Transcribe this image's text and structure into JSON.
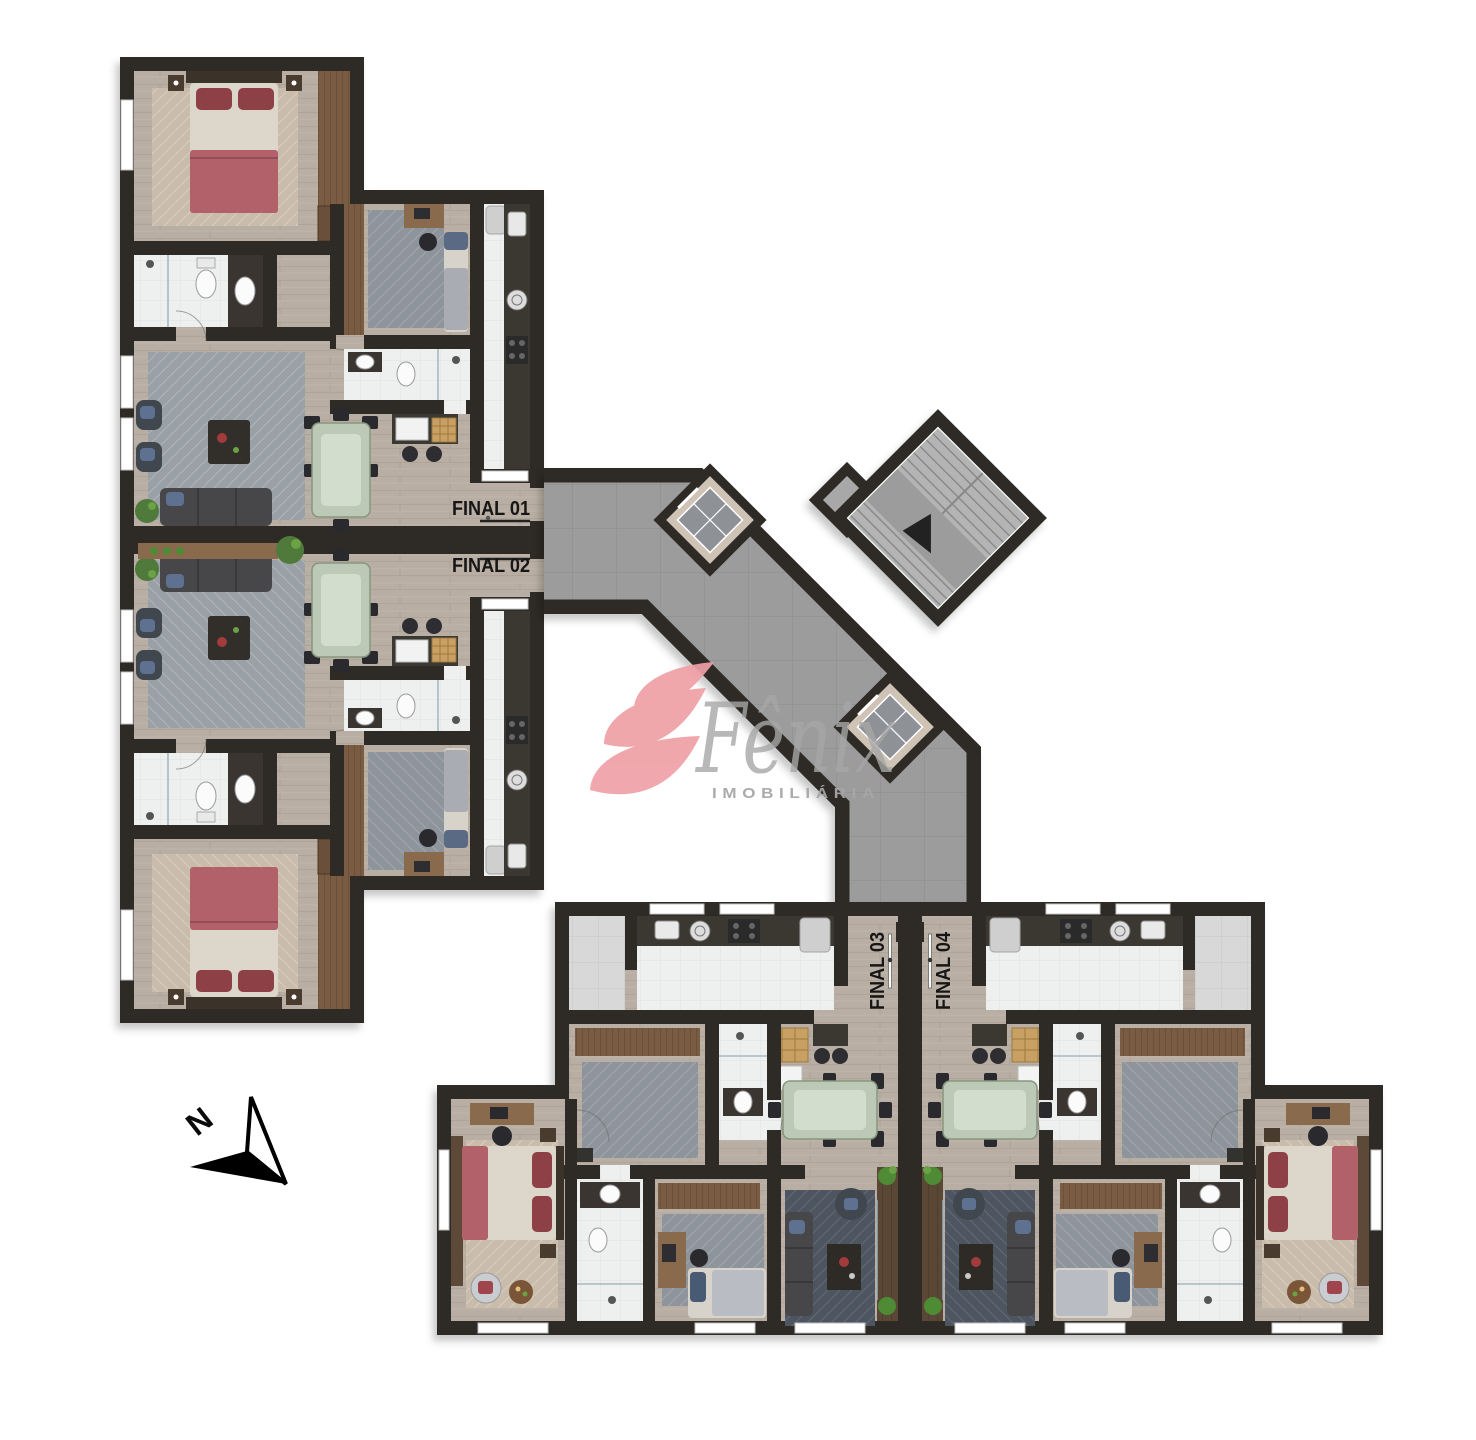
{
  "document": {
    "kind": "residential floor plan rendering",
    "background": "#ffffff"
  },
  "units": [
    {
      "label": "FINAL 01",
      "orientation": "horizontal"
    },
    {
      "label": "FINAL 02",
      "orientation": "horizontal"
    },
    {
      "label": "FINAL 03",
      "orientation": "vertical"
    },
    {
      "label": "FINAL 04",
      "orientation": "vertical"
    }
  ],
  "logo": {
    "brand": "Fênix",
    "tagline": "IMOBILIÁRIA",
    "flame_color": "#efa0a6",
    "text_color": "#a7a7a7"
  },
  "compass": {
    "label": "N"
  },
  "palette": {
    "wall": "#2f2b28",
    "wood_floor": "#b9aea3",
    "corridor_tile": "#9c9c9c",
    "bathroom_tile": "#eef0f0",
    "terrace_tile": "#d8d8d8",
    "stair_concrete": "#b4b4b4",
    "elevator_frame": "#cec3b4",
    "elevator_cabin": "#8e9296",
    "bed_red": "#b2606a",
    "pillow_red": "#8e4046",
    "sofa_gray": "#47474a",
    "armchair_blue": "#5f7191",
    "rug_gray": "#99a1a6",
    "rug_slate": "#8d949b",
    "rug_beige": "#c9bcab",
    "rug_dark": "#4e5560",
    "wardrobe_brown": "#7a5c42",
    "console_brown": "#8a6a4d",
    "balcony_brown": "#5a4636",
    "glass_table_green": "#bcc9b6",
    "counter_dark": "#3b3733",
    "plant_green": "#4f8a35",
    "brick_oven": "#c9a063"
  }
}
